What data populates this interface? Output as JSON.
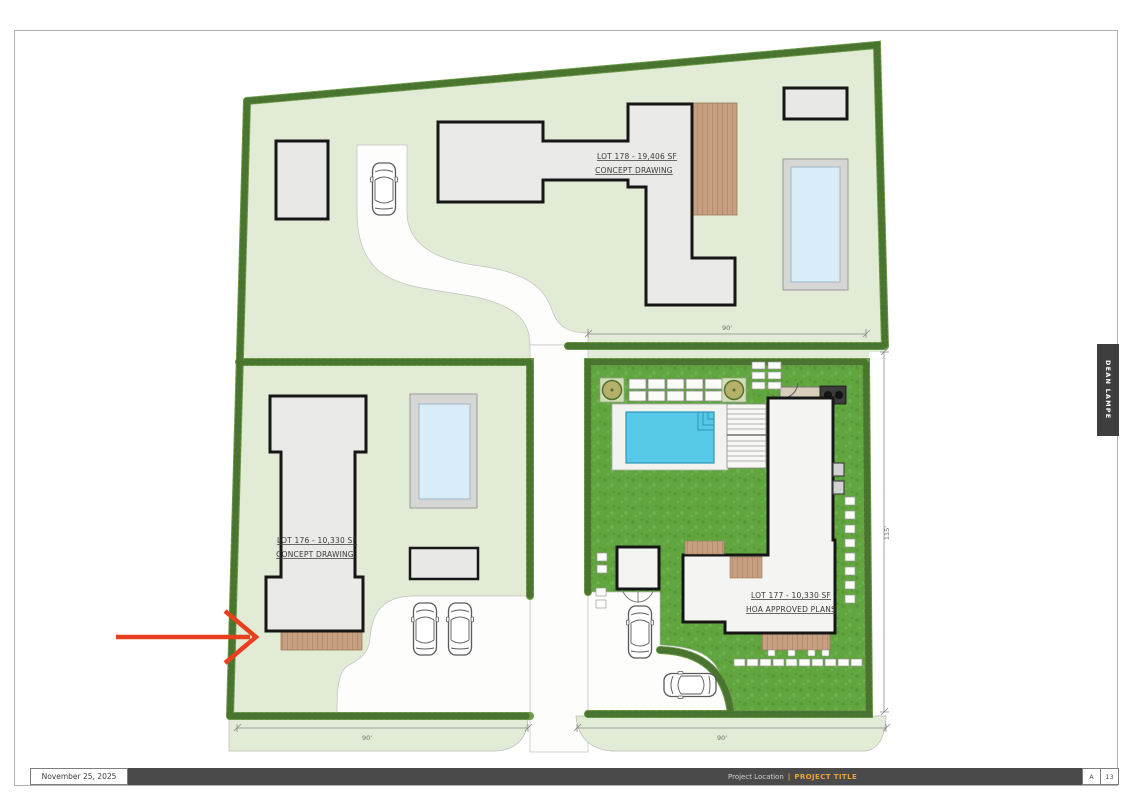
{
  "page": {
    "date": "November 25, 2025",
    "footer": {
      "project_location": "Project Location",
      "separator": "|",
      "project_title": "PROJECT TITLE",
      "sheet_letter": "A",
      "sheet_number": "13"
    },
    "side_tab": "DEAN LAMPE"
  },
  "site_plan": {
    "lots": [
      {
        "number": "LOT 178",
        "label": "LOT 178 - 19,406 SF",
        "status": "CONCEPT DRAWING"
      },
      {
        "number": "LOT 176",
        "label": "LOT 176 - 10,330 SF",
        "status": "CONCEPT DRAWING"
      },
      {
        "number": "LOT 177",
        "label": "LOT 177 - 10,330 SF",
        "status": "HOA APPROVED PLANS"
      }
    ],
    "dimensions": {
      "lot177_top": "90'",
      "lot177_right": "115'",
      "bottom_left": "90'",
      "bottom_right": "90'"
    },
    "colors": {
      "grass": "#60a53e",
      "lawn_pale": "#e2ebd5",
      "hedge": "#4a7530",
      "pool_water_bright": "#57c9e8",
      "pool_water_pale": "#d8edf8",
      "wood_deck": "#c7a083",
      "annotation_arrow": "#e8401f",
      "footer_bar": "#4a4a4a",
      "accent_orange": "#e8a33d"
    }
  }
}
